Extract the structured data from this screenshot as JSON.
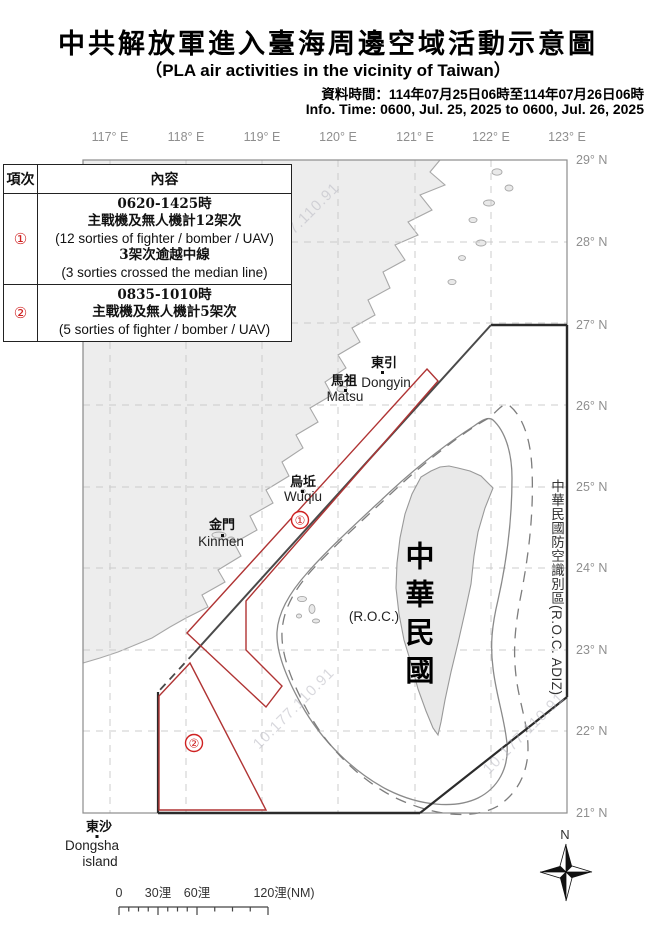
{
  "header": {
    "title_zh": "中共解放軍進入臺海周邊空域活動示意圖",
    "title_en": "（PLA air activities in the vicinity of Taiwan）",
    "info_zh": "資料時間：114年07月25日06時至114年07月26日06時",
    "info_en": "Info. Time: 0600, Jul. 25, 2025 to 0600, Jul. 26, 2025"
  },
  "table": {
    "col_item": "項次",
    "col_content": "內容",
    "rows": [
      {
        "num": "①",
        "lines": [
          "0620-1425時",
          "主戰機及無人機計12架次",
          "(12 sorties of fighter / bomber / UAV)",
          "3架次逾越中線",
          "(3 sorties crossed the median line)"
        ]
      },
      {
        "num": "②",
        "lines": [
          "0835-1010時",
          "主戰機及無人機計5架次",
          "(5 sorties of fighter / bomber / UAV)"
        ]
      }
    ]
  },
  "map": {
    "lon_labels": [
      "117° E",
      "118° E",
      "119° E",
      "120° E",
      "121° E",
      "122° E",
      "123° E"
    ],
    "lat_labels": [
      "29° N",
      "28° N",
      "27° N",
      "26° N",
      "25° N",
      "24° N",
      "23° N",
      "22° N",
      "21° N"
    ],
    "adiz_text": "中華民國防空識別區(R.O.C. ADIZ)",
    "taiwan_vertical": "中華民國",
    "roc_label": "(R.O.C.)",
    "zone1_label": "①",
    "zone2_label": "②",
    "places": {
      "dongyin_zh": "東引",
      "dongyin_en": "Dongyin",
      "matsu_zh": "馬祖",
      "matsu_en": "Matsu",
      "wuqiu_zh": "烏坵",
      "wuqiu_en": "Wuqiu",
      "kinmen_zh": "金門",
      "kinmen_en": "Kinmen",
      "dongsha_zh": "東沙",
      "dongsha_en1": "Dongsha",
      "dongsha_en2": "island"
    },
    "scale": {
      "t0": "0",
      "t30": "30浬",
      "t60": "60浬",
      "t120": "120浬(NM)"
    },
    "compass_n": "N",
    "watermark": "10.177.110.91",
    "colors": {
      "zone_red": "#b03434",
      "label_red": "#cf2121",
      "adiz_black": "#2b2b2b",
      "contour_gray": "#8a8a8a",
      "land_fill": "#ededed",
      "grid_gray": "#cccccc"
    }
  }
}
